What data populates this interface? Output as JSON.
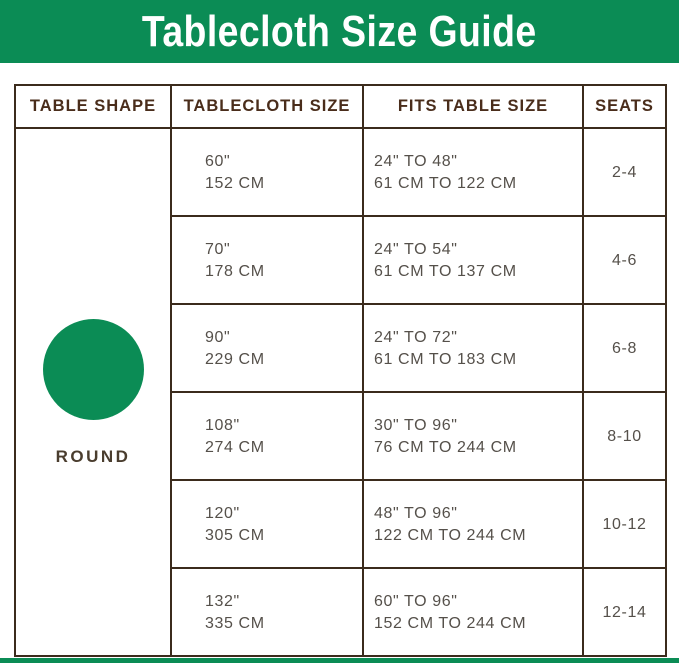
{
  "title": "Tablecloth Size Guide",
  "colors": {
    "brand_green": "#0b8c55",
    "header_text": "#4a2d1b",
    "body_text": "#55504a",
    "border": "#3b2b1c",
    "title_text": "#ffffff",
    "background": "#ffffff"
  },
  "shape": {
    "label": "ROUND",
    "icon": "green-circle"
  },
  "chart_data": {
    "type": "table",
    "title": "Tablecloth Size Guide",
    "columns": [
      "TABLE SHAPE",
      "TABLECLOTH SIZE",
      "FITS TABLE SIZE",
      "SEATS"
    ],
    "table_shape": "ROUND",
    "rows": [
      {
        "tablecloth_size": [
          "60\"",
          "152 CM"
        ],
        "fits_table_size": [
          "24\" TO 48\"",
          "61 CM TO 122 CM"
        ],
        "seats": "2-4"
      },
      {
        "tablecloth_size": [
          "70\"",
          "178 CM"
        ],
        "fits_table_size": [
          "24\" TO 54\"",
          "61 CM TO 137 CM"
        ],
        "seats": "4-6"
      },
      {
        "tablecloth_size": [
          "90\"",
          "229 CM"
        ],
        "fits_table_size": [
          "24\" TO 72\"",
          "61 CM TO 183 CM"
        ],
        "seats": "6-8"
      },
      {
        "tablecloth_size": [
          "108\"",
          "274 CM"
        ],
        "fits_table_size": [
          "30\" TO 96\"",
          "76 CM TO 244 CM"
        ],
        "seats": "8-10"
      },
      {
        "tablecloth_size": [
          "120\"",
          "305 CM"
        ],
        "fits_table_size": [
          "48\" TO 96\"",
          "122 CM TO 244 CM"
        ],
        "seats": "10-12"
      },
      {
        "tablecloth_size": [
          "132\"",
          "335 CM"
        ],
        "fits_table_size": [
          "60\" TO 96\"",
          "152 CM TO 244 CM"
        ],
        "seats": "12-14"
      }
    ]
  }
}
